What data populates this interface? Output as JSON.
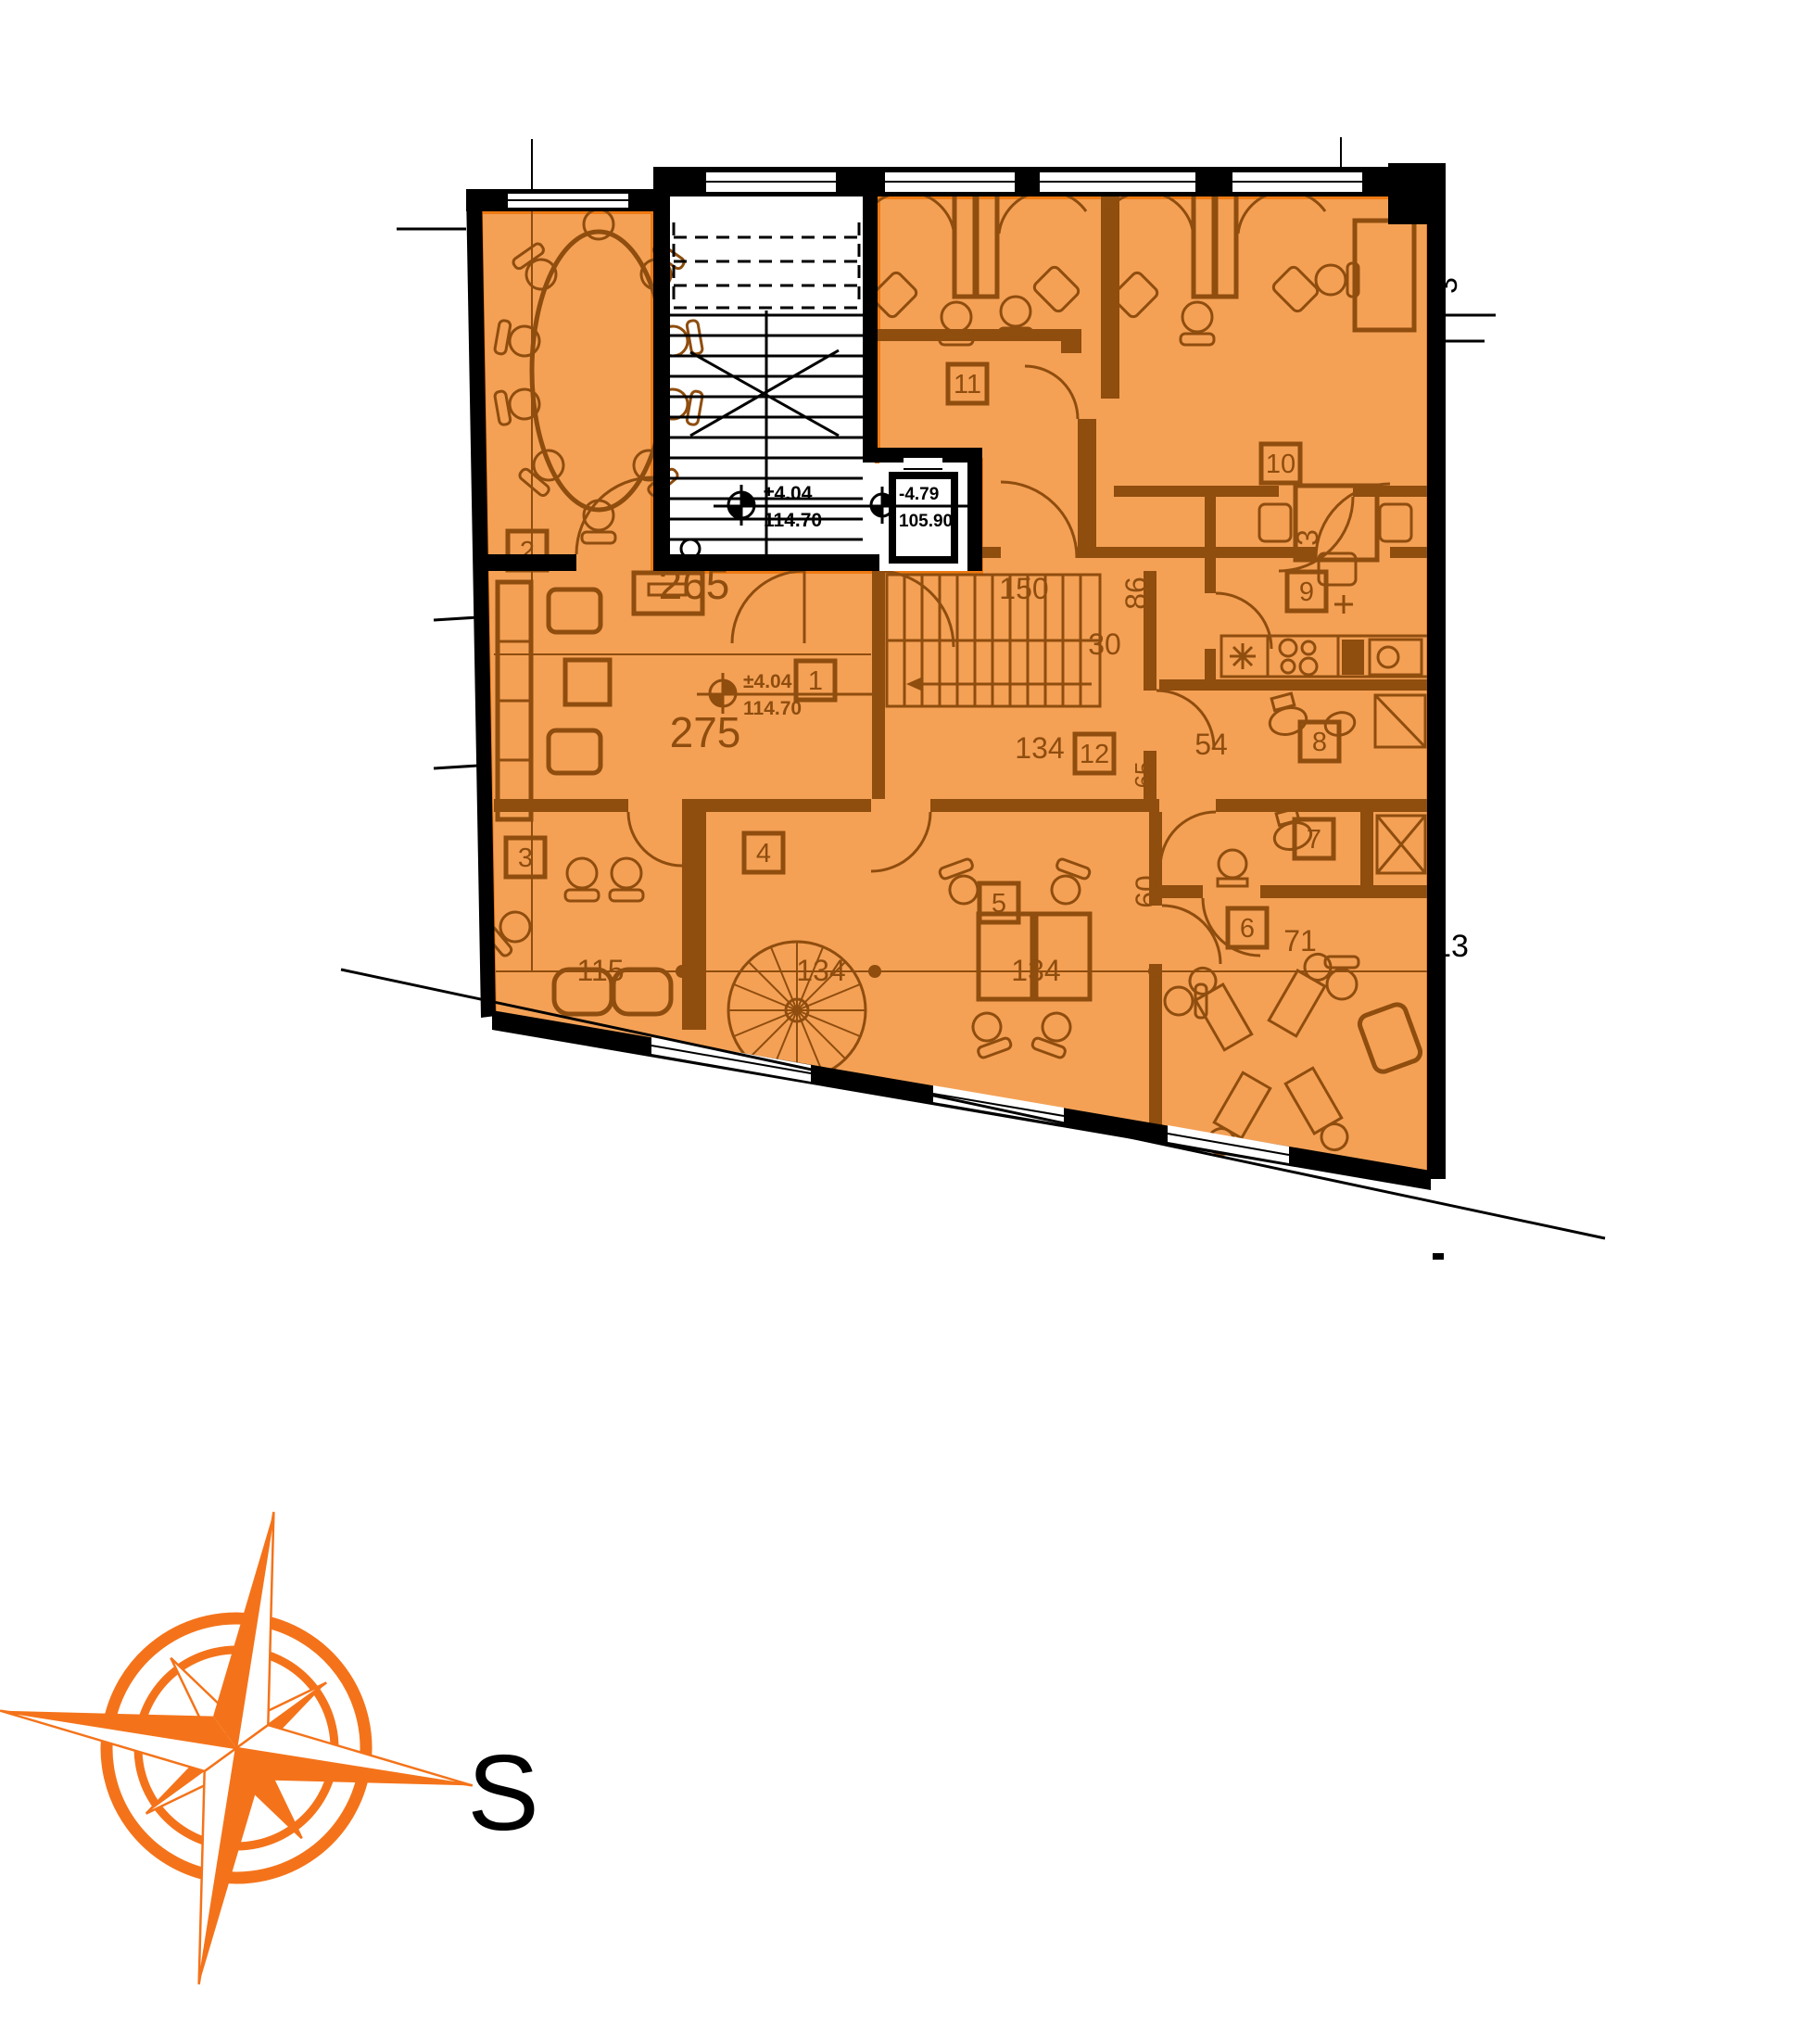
{
  "colors": {
    "background": "#FFFFFF",
    "wall": "#000000",
    "plan_line": "#8F4D0E",
    "highlight_fill": "#F4A156",
    "highlight_stroke": "#EE7A12",
    "compass_orange": "#F4731A"
  },
  "plan": {
    "room_tags": [
      "1",
      "2",
      "3",
      "4",
      "5",
      "6",
      "7",
      "8",
      "9",
      "10",
      "11",
      "12"
    ],
    "dims": [
      "265",
      "275",
      "150",
      "30",
      "86",
      "134",
      "54",
      "65",
      "60",
      "115",
      "134",
      "134",
      "71",
      "13",
      "3",
      "3"
    ],
    "levels": [
      {
        "value": "±4.04",
        "elevation": "114.70"
      },
      {
        "value": "-4.79",
        "elevation": "105.90"
      },
      {
        "value": "±4.04",
        "elevation": "114.70"
      }
    ]
  },
  "compass": {
    "label": "S"
  }
}
